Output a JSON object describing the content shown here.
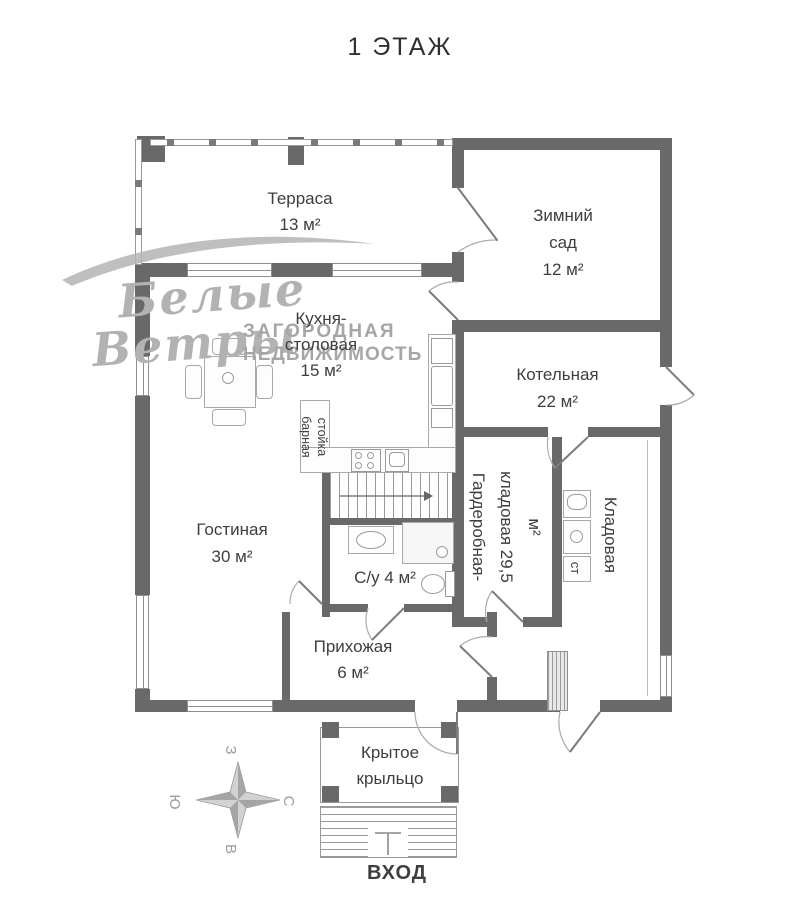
{
  "title": "1 ЭТАЖ",
  "rooms": {
    "terrace": {
      "name": "Терраса",
      "area": "13 м²"
    },
    "winter_garden": {
      "line1": "Зимний",
      "line2": "сад",
      "area": "12 м²"
    },
    "kitchen": {
      "line1": "Кухня-",
      "line2": "столовая",
      "area": "15 м²"
    },
    "boiler": {
      "name": "Котельная",
      "area": "22 м²"
    },
    "living": {
      "name": "Гостиная",
      "area": "30 м²"
    },
    "bathroom": {
      "name": "С/у 4 м²"
    },
    "hallway": {
      "name": "Прихожая",
      "area": "6 м²"
    },
    "wardrobe": {
      "line1": "Гардеробная-",
      "line2": "кладовая 29,5",
      "line3": "м²"
    },
    "pantry": {
      "name": "Кладовая"
    },
    "porch": {
      "line1": "Крытое",
      "line2": "крыльцо"
    }
  },
  "labels": {
    "entrance": "ВХОД",
    "bar_line1": "барная",
    "bar_line2": "стойка",
    "washing_machine": "ст"
  },
  "compass": {
    "north": "С",
    "south": "Ю",
    "west": "З",
    "east": "В"
  },
  "watermark": {
    "script_line1": "Белые",
    "script_line2": "Ветры",
    "caps_line1": "ЗАГОРОДНАЯ",
    "caps_line2": "НЕДВИЖИМОСТЬ"
  },
  "colors": {
    "wall": "#696969",
    "line": "#9a9a9a",
    "text": "#3e3e3e",
    "watermark": "#b2b2b2"
  }
}
